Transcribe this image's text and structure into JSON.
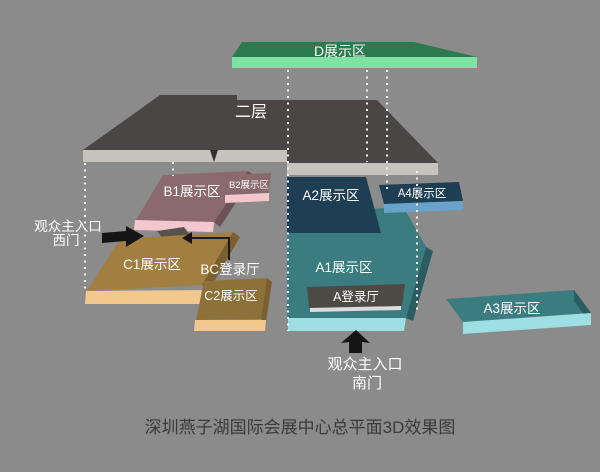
{
  "caption": "深圳燕子湖国际会展中心总平面3D效果图",
  "areas": {
    "second_floor": "二层",
    "d": "D展示区",
    "b1": "B1展示区",
    "b2": "B2展示区",
    "a1": "A1展示区",
    "a2": "A2展示区",
    "a3": "A3展示区",
    "a4": "A4展示区",
    "c1": "C1展示区",
    "c2": "C2展示区",
    "a_hall": "A登录厅",
    "bc_hall": "BC登录厅"
  },
  "entrances": {
    "west": {
      "line1": "观众主入口",
      "line2": "西门"
    },
    "south": {
      "line1": "观众主入口",
      "line2": "南门"
    }
  },
  "palette": {
    "background": "#8b8b8b",
    "second_floor_top": "#4a4645",
    "second_floor_edge": "#c6c2be",
    "d_top": "#2d7a4e",
    "d_front": "#7ee2a4",
    "b_top": "#8a6a6c",
    "b_front": "#f2c8cc",
    "a_navy_top": "#1e3f53",
    "a4_front": "#69a2ca",
    "a_teal_top": "#3a7c80",
    "a_teal_front": "#9edfe3",
    "c_top": "#a27e41",
    "c_front": "#f3c88e",
    "hall_bar": "#4d4a44",
    "connector": "#57534c",
    "arrow": "#151515",
    "dotted_line": "#f3f3f3",
    "label_text": "#ffffff",
    "caption_text": "#3a3a3a"
  }
}
